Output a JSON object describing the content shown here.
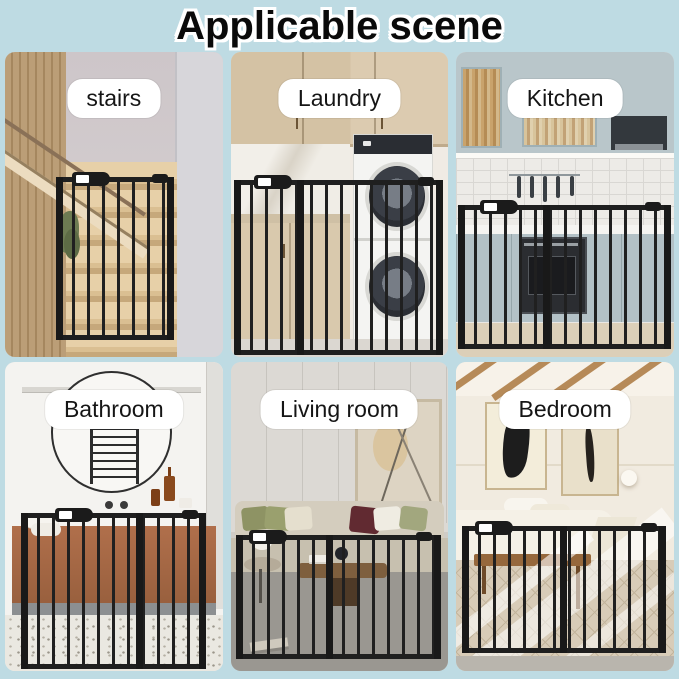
{
  "title": "Applicable scene",
  "panels": [
    {
      "id": "stairs",
      "label": "stairs"
    },
    {
      "id": "laundry",
      "label": "Laundry"
    },
    {
      "id": "kitchen",
      "label": "Kitchen"
    },
    {
      "id": "bathroom",
      "label": "Bathroom"
    },
    {
      "id": "living-room",
      "label": "Living room"
    },
    {
      "id": "bedroom",
      "label": "Bedroom"
    }
  ],
  "colors": {
    "background": "#bedbe3",
    "title_text": "#0a0a0a",
    "title_outline": "#ffffff",
    "label_background": "#ffffff",
    "label_text": "#151515",
    "gate_metal": "#1f1f1f"
  }
}
